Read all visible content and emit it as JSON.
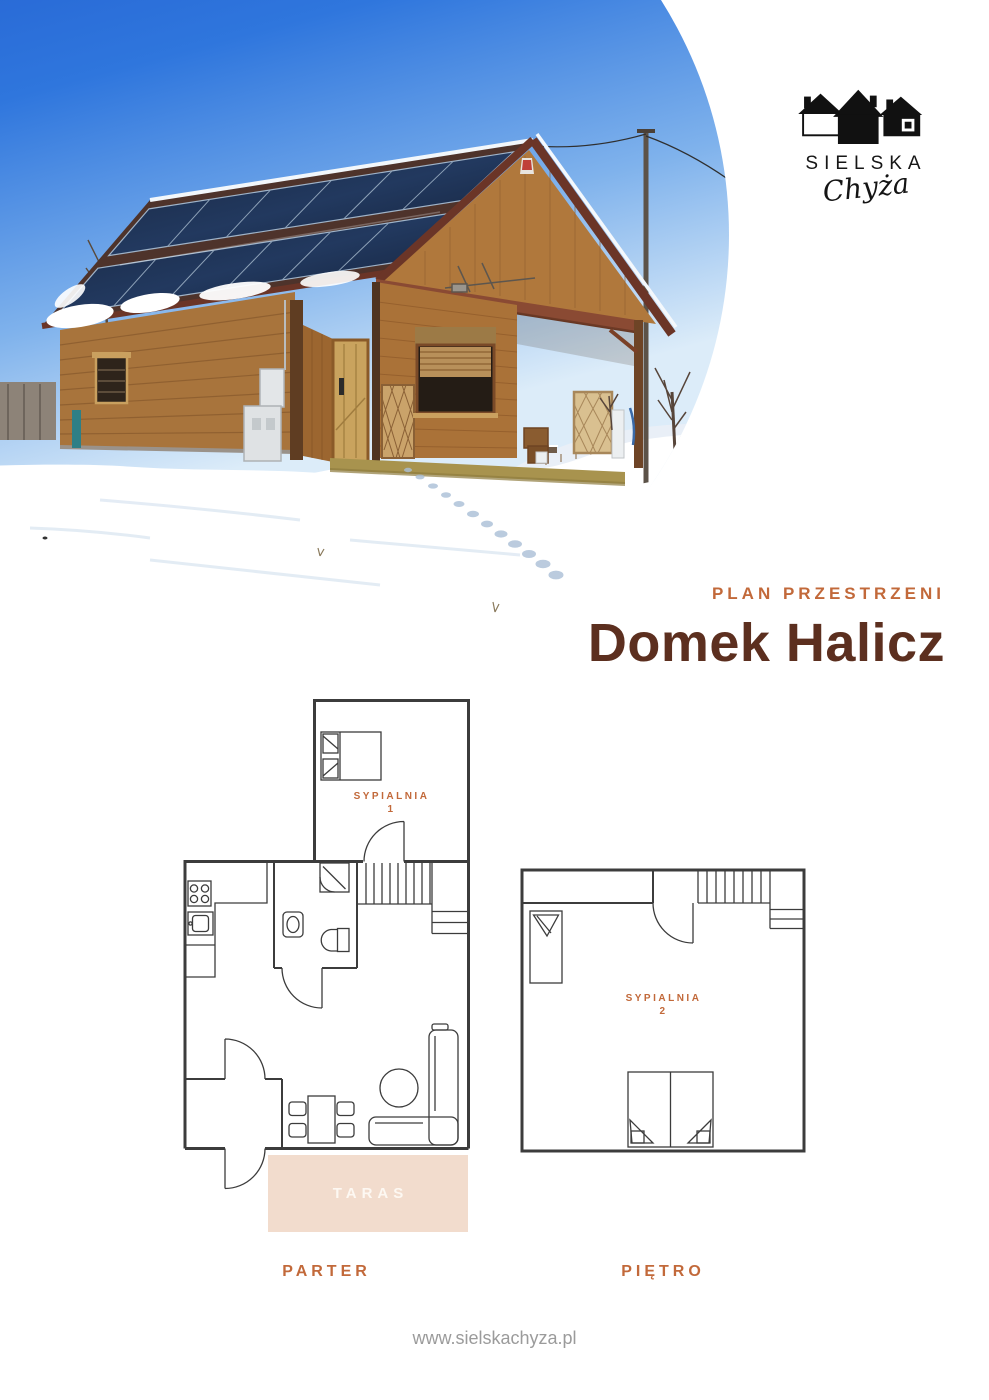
{
  "logo": {
    "brand": "SIELSKA",
    "script": "Chyża",
    "icon": "three-houses"
  },
  "header": {
    "eyebrow": "PLAN PRZESTRZENI",
    "title": "Domek Halicz"
  },
  "floorplans": {
    "parter": {
      "caption": "PARTER",
      "bedroom_label": "SYPIALNIA",
      "bedroom_number": "1",
      "terrace_label": "TARAS"
    },
    "pietro": {
      "caption": "PIĘTRO",
      "bedroom_label": "SYPIALNIA",
      "bedroom_number": "2"
    }
  },
  "footer": {
    "website": "www.sielskachyza.pl"
  },
  "colors": {
    "accent": "#c2693a",
    "title_brown": "#5c2f1f",
    "terrace_fill": "#f2dccd",
    "terrace_text": "#fdf8f2",
    "plan_lines": "#3c3c3c",
    "footer_gray": "#9b9b9b",
    "logo_black": "#111111"
  }
}
